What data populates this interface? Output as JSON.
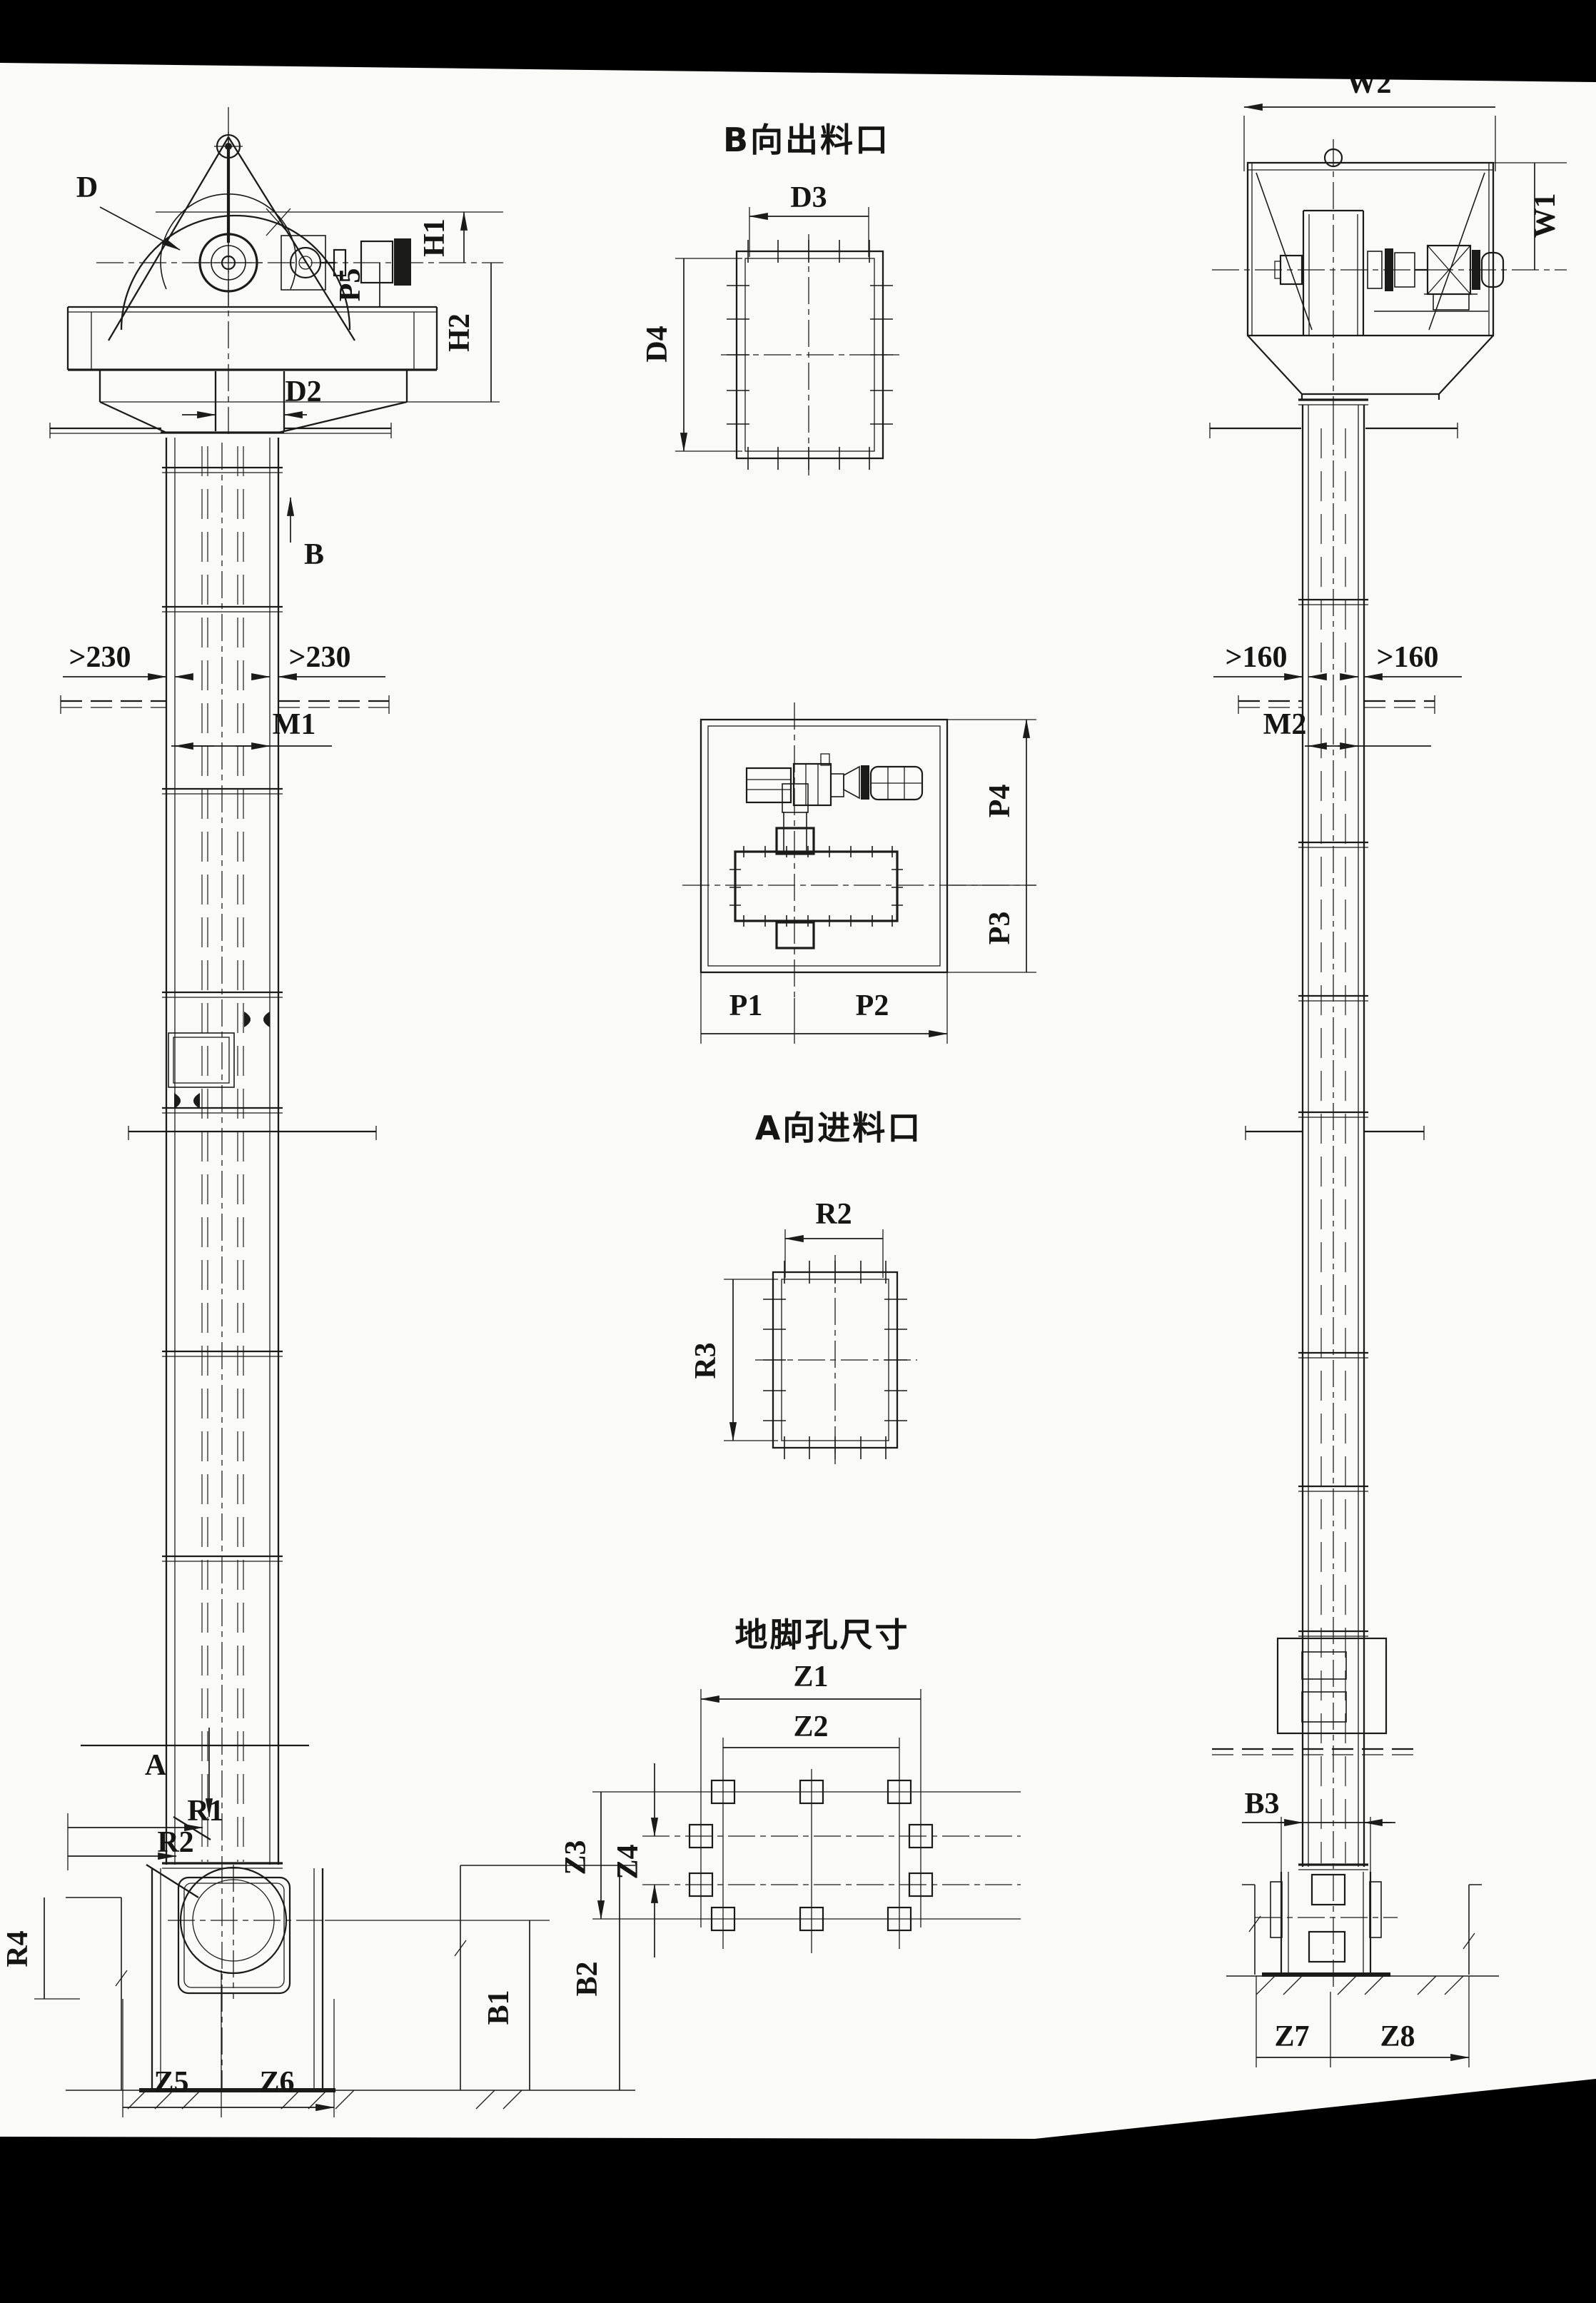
{
  "front_view": {
    "d": "D",
    "h1": "H1",
    "p5": "P5",
    "h2": "H2",
    "d2": "D2",
    "b": "B",
    "clearance_left": ">230",
    "clearance_right": ">230",
    "m1": "M1",
    "a": "A",
    "r1": "R1",
    "r2": "R2",
    "r4": "R4",
    "b1": "B1",
    "b2": "B2",
    "z5": "Z5",
    "z6": "Z6"
  },
  "outlet_view": {
    "title": "B向出料口",
    "d3": "D3",
    "d4": "D4"
  },
  "platform_view": {
    "p1": "P1",
    "p2": "P2",
    "p3": "P3",
    "p4": "P4"
  },
  "inlet_view": {
    "title": "A向进料口",
    "r2": "R2",
    "r3": "R3"
  },
  "anchor_view": {
    "title": "地脚孔尺寸",
    "z1": "Z1",
    "z2": "Z2",
    "z3": "Z3",
    "z4": "Z4"
  },
  "side_view": {
    "w2": "W2",
    "w1": "W1",
    "clearance_left": ">160",
    "clearance_right": ">160",
    "m2": "M2",
    "b3": "B3",
    "z7": "Z7",
    "z8": "Z8"
  },
  "colors": {
    "ink": "#1b1b17",
    "paper": "#fafaf7",
    "scan_band": "#000000"
  }
}
